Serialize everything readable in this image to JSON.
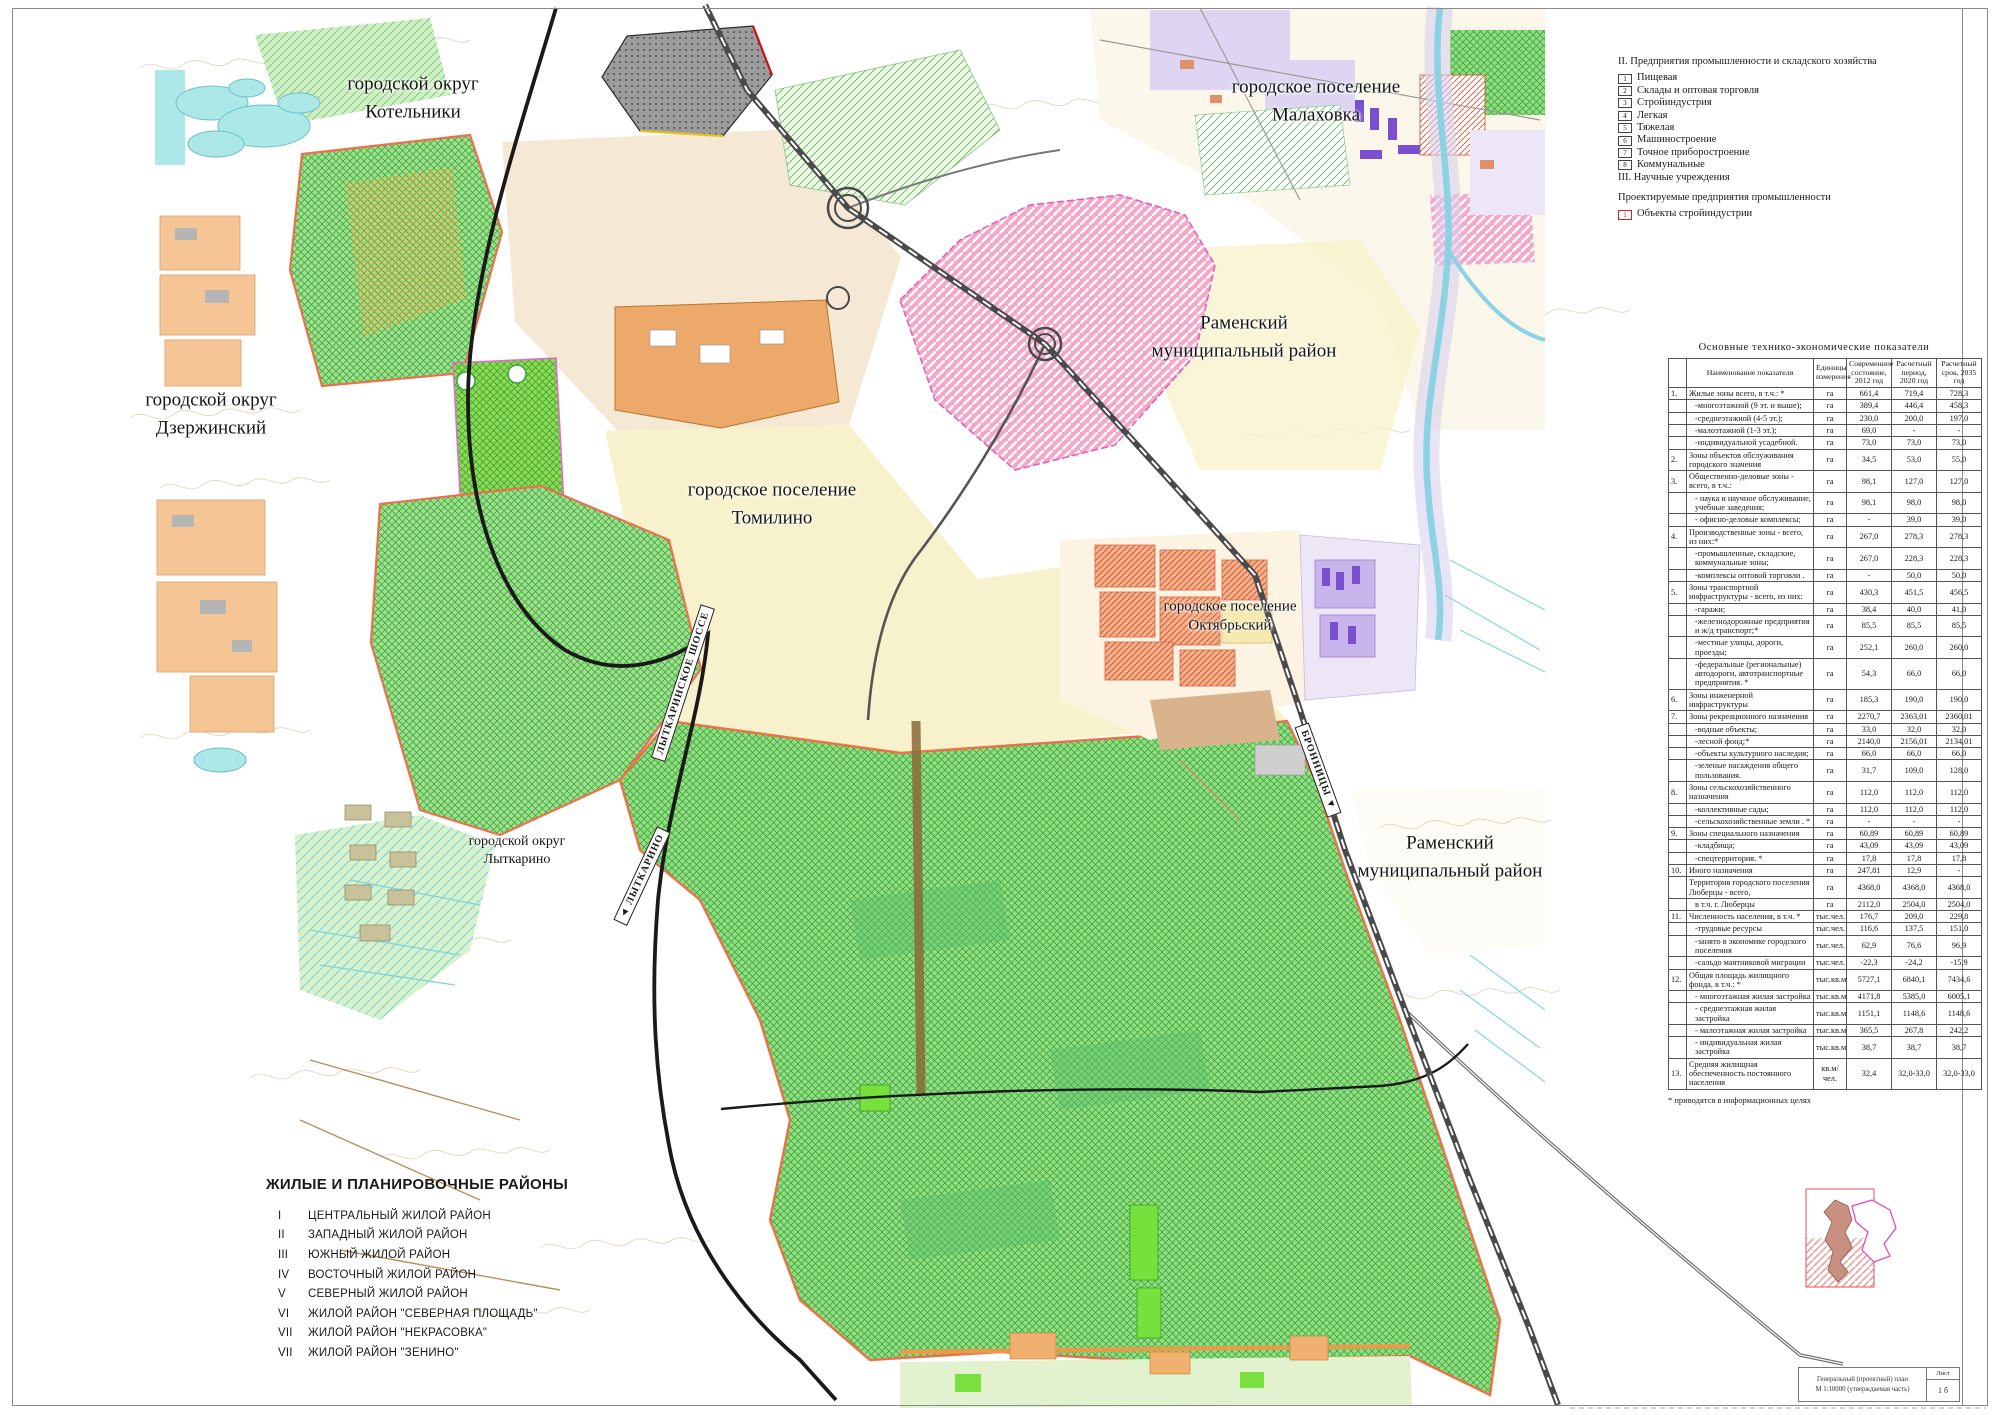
{
  "map": {
    "labels": [
      {
        "id": "kotelniki",
        "text": "городской округ\nКотельники"
      },
      {
        "id": "malahovka",
        "text": "городское поселение\nМалаховка"
      },
      {
        "id": "ramensky-ne",
        "text": "Раменский\nмуниципальный район"
      },
      {
        "id": "dzerzhinsky",
        "text": "городской округ\nДзержинский"
      },
      {
        "id": "tomilino",
        "text": "городское поселение\nТомилино"
      },
      {
        "id": "oktyabrsky",
        "text": "городское поселение\nОктябрьский"
      },
      {
        "id": "lytkarino",
        "text": "городской округ\nЛыткарино"
      },
      {
        "id": "ramensky-se",
        "text": "Раменский\nмуниципальный район"
      }
    ],
    "road_signs": [
      {
        "id": "lytkarinskoe-shosse",
        "text": "ЛЫТКАРИНСКОЕ ШОССЕ"
      },
      {
        "id": "lytkarino-direction",
        "text": "◄ ЛЫТКАРИНО"
      },
      {
        "id": "bronnitsy-direction",
        "text": "БРОННИЦЫ ▼"
      }
    ]
  },
  "industry_legend": {
    "section2_title": "II. Предприятия промышленности и складского хозяйства",
    "items": [
      {
        "num": "1",
        "label": "Пищевая"
      },
      {
        "num": "2",
        "label": "Склады и оптовая торговля"
      },
      {
        "num": "3",
        "label": "Стройиндустрия"
      },
      {
        "num": "4",
        "label": "Легкая"
      },
      {
        "num": "5",
        "label": "Тяжелая"
      },
      {
        "num": "6",
        "label": "Машиностроение"
      },
      {
        "num": "7",
        "label": "Точное приборостроение"
      },
      {
        "num": "8",
        "label": "Коммунальные"
      }
    ],
    "section3_title": "III.  Научные учреждения",
    "projected_title": "Проектируемые предприятия промышленности",
    "projected_items": [
      {
        "num": "1",
        "label": "Объекты стройиндустрии"
      }
    ]
  },
  "indicators_table": {
    "title": "Основные технико-экономические показатели",
    "columns": [
      "Наименование показателя",
      "Единицы измерения",
      "Современное состояние, 2012 год",
      "Расчетный период, 2020 год",
      "Расчетный срок, 2035 год"
    ],
    "rows": [
      {
        "n": "1.",
        "name": "Жилые зоны всего, в т.ч.: *",
        "unit": "га",
        "v": [
          "661,4",
          "719,4",
          "728,3"
        ]
      },
      {
        "n": "",
        "sub": true,
        "name": "-многоэтажной (9 эт. и выше);",
        "unit": "га",
        "v": [
          "389,4",
          "446,4",
          "458,3"
        ]
      },
      {
        "n": "",
        "sub": true,
        "name": "-среднеэтажной (4-5 эт.);",
        "unit": "га",
        "v": [
          "230,0",
          "200,0",
          "197,0"
        ]
      },
      {
        "n": "",
        "sub": true,
        "name": "-малоэтажной (1-3 эт.);",
        "unit": "га",
        "v": [
          "69,0",
          "-",
          "-"
        ]
      },
      {
        "n": "",
        "sub": true,
        "name": "-индивидуальной усадебной.",
        "unit": "га",
        "v": [
          "73,0",
          "73,0",
          "73,0"
        ]
      },
      {
        "n": "2.",
        "name": "Зоны объектов обслуживания городского значения",
        "unit": "га",
        "v": [
          "34,5",
          "53,0",
          "55,0"
        ]
      },
      {
        "n": "3.",
        "name": "Общественно-деловые зоны - всего, в т.ч.:",
        "unit": "га",
        "v": [
          "98,1",
          "127,0",
          "127,0"
        ]
      },
      {
        "n": "",
        "sub": true,
        "name": "- наука и научное обслуживание, учебные заведения;",
        "unit": "га",
        "v": [
          "98,1",
          "98,0",
          "98,0"
        ]
      },
      {
        "n": "",
        "sub": true,
        "name": "- офисно-деловые комплексы;",
        "unit": "га",
        "v": [
          "-",
          "39,0",
          "39,0"
        ]
      },
      {
        "n": "4.",
        "name": "Производственные зоны - всего, из них:*",
        "unit": "га",
        "v": [
          "267,0",
          "278,3",
          "278,3"
        ]
      },
      {
        "n": "",
        "sub": true,
        "name": "-промышленные, складские, коммунальные зоны;",
        "unit": "га",
        "v": [
          "267,0",
          "228,3",
          "228,3"
        ]
      },
      {
        "n": "",
        "sub": true,
        "name": "-комплексы оптовой торговли .",
        "unit": "га",
        "v": [
          "-",
          "50,0",
          "50,0"
        ]
      },
      {
        "n": "5.",
        "name": "Зоны транспортной инфраструктуры - всего, из них:",
        "unit": "га",
        "v": [
          "430,3",
          "451,5",
          "456,5"
        ]
      },
      {
        "n": "",
        "sub": true,
        "name": "-гаражи;",
        "unit": "га",
        "v": [
          "38,4",
          "40,0",
          "41,0"
        ]
      },
      {
        "n": "",
        "sub": true,
        "name": "-железнодорожные предприятия и ж/д транспорт;*",
        "unit": "га",
        "v": [
          "85,5",
          "85,5",
          "85,5"
        ]
      },
      {
        "n": "",
        "sub": true,
        "name": "-местные улицы, дороги, проезды;",
        "unit": "га",
        "v": [
          "252,1",
          "260,0",
          "260,0"
        ]
      },
      {
        "n": "",
        "sub": true,
        "name": "-федеральные (региональные) автодороги, автотранспортные предприятия. *",
        "unit": "га",
        "v": [
          "54,3",
          "66,0",
          "66,0"
        ]
      },
      {
        "n": "6.",
        "name": "Зоны инженерной инфраструктуры",
        "unit": "га",
        "v": [
          "185,3",
          "190,0",
          "190,0"
        ]
      },
      {
        "n": "7.",
        "name": "Зоны рекреационного назначения",
        "unit": "га",
        "v": [
          "2270,7",
          "2363,01",
          "2360,01"
        ]
      },
      {
        "n": "",
        "sub": true,
        "name": "-водные объекты;",
        "unit": "га",
        "v": [
          "33,0",
          "32,0",
          "32,0"
        ]
      },
      {
        "n": "",
        "sub": true,
        "name": "-лесной фонд;*",
        "unit": "га",
        "v": [
          "2140,0",
          "2156,01",
          "2134,01"
        ]
      },
      {
        "n": "",
        "sub": true,
        "name": "-объекты культурного наследия;",
        "unit": "га",
        "v": [
          "66,0",
          "66,0",
          "66,0"
        ]
      },
      {
        "n": "",
        "sub": true,
        "name": "-зеленые насаждения общего пользования.",
        "unit": "га",
        "v": [
          "31,7",
          "109,0",
          "128,0"
        ]
      },
      {
        "n": "8.",
        "name": "Зоны сельскохозяйственного назначения",
        "unit": "га",
        "v": [
          "112,0",
          "112,0",
          "112,0"
        ]
      },
      {
        "n": "",
        "sub": true,
        "name": "-коллективные сады;",
        "unit": "га",
        "v": [
          "112,0",
          "112,0",
          "112,0"
        ]
      },
      {
        "n": "",
        "sub": true,
        "name": "-сельскохозяйственные земли . *",
        "unit": "га",
        "v": [
          "-",
          "-",
          "-"
        ]
      },
      {
        "n": "9.",
        "name": "Зоны специального назначения",
        "unit": "га",
        "v": [
          "60,89",
          "60,89",
          "60,89"
        ]
      },
      {
        "n": "",
        "sub": true,
        "name": "-кладбища;",
        "unit": "га",
        "v": [
          "43,09",
          "43,09",
          "43,09"
        ]
      },
      {
        "n": "",
        "sub": true,
        "name": "-спецтерритория. *",
        "unit": "га",
        "v": [
          "17,8",
          "17,8",
          "17,8"
        ]
      },
      {
        "n": "10.",
        "name": "Иного назначения",
        "unit": "га",
        "v": [
          "247,81",
          "12,9",
          "-"
        ]
      },
      {
        "n": "",
        "name": "Территория городского поселения Люберцы - всего,",
        "unit": "га",
        "v": [
          "4368,0",
          "4368,0",
          "4368,0"
        ]
      },
      {
        "n": "",
        "sub": true,
        "name": "в т.ч. г. Люберцы",
        "unit": "га",
        "v": [
          "2112,0",
          "2504,0",
          "2504,0"
        ]
      },
      {
        "n": "11.",
        "name": "Численность населения, в т.ч. *",
        "unit": "тыс.чел.",
        "v": [
          "176,7",
          "209,0",
          "229,8"
        ]
      },
      {
        "n": "",
        "sub": true,
        "name": "-трудовые ресурсы",
        "unit": "тыс.чел.",
        "v": [
          "116,6",
          "137,5",
          "151,0"
        ]
      },
      {
        "n": "",
        "sub": true,
        "name": "-занято в экономике городского поселения",
        "unit": "тыс.чел.",
        "v": [
          "62,9",
          "76,6",
          "96,9"
        ]
      },
      {
        "n": "",
        "sub": true,
        "name": "-сальдо маятниковой миграции",
        "unit": "тыс.чел.",
        "v": [
          "-22,3",
          "-24,2",
          "-15,9"
        ]
      },
      {
        "n": "12.",
        "name": "Общая площадь жилищного фонда, в т.ч.: *",
        "unit": "тыс.кв.м",
        "v": [
          "5727,1",
          "6840,1",
          "7434,6"
        ]
      },
      {
        "n": "",
        "sub": true,
        "name": "- многоэтажная жилая застройка",
        "unit": "тыс.кв.м",
        "v": [
          "4171,8",
          "5385,0",
          "6005,1"
        ]
      },
      {
        "n": "",
        "sub": true,
        "name": "- среднеэтажная жилая застройка",
        "unit": "тыс.кв.м",
        "v": [
          "1151,1",
          "1148,6",
          "1148,6"
        ]
      },
      {
        "n": "",
        "sub": true,
        "name": "- малоэтажная жилая застройка",
        "unit": "тыс.кв.м",
        "v": [
          "365,5",
          "267,8",
          "242,2"
        ]
      },
      {
        "n": "",
        "sub": true,
        "name": "- индивидуальная жилая застройка",
        "unit": "тыс.кв.м",
        "v": [
          "38,7",
          "38,7",
          "38,7"
        ]
      },
      {
        "n": "13.",
        "name": "Средняя жилищная обеспеченность постоянного населения",
        "unit": "кв.м/чел.",
        "v": [
          "32,4",
          "32,0-33,0",
          "32,0-33,0"
        ]
      }
    ],
    "footnote": "* приводятся в информационных целях"
  },
  "districts_legend": {
    "title": "ЖИЛЫЕ И ПЛАНИРОВОЧНЫЕ РАЙОНЫ",
    "items": [
      {
        "num": "I",
        "label": "ЦЕНТРАЛЬНЫЙ ЖИЛОЙ РАЙОН"
      },
      {
        "num": "II",
        "label": "ЗАПАДНЫЙ ЖИЛОЙ  РАЙОН"
      },
      {
        "num": "III",
        "label": "ЮЖНЫЙ  ЖИЛОЙ  РАЙОН"
      },
      {
        "num": "IV",
        "label": "ВОСТОЧНЫЙ ЖИЛОЙ РАЙОН"
      },
      {
        "num": "V",
        "label": "СЕВЕРНЫЙ  ЖИЛОЙ  РАЙОН"
      },
      {
        "num": "VI",
        "label": "ЖИЛОЙ  РАЙОН \"СЕВЕРНАЯ ПЛОЩАДЬ\""
      },
      {
        "num": "VII",
        "label": "ЖИЛОЙ РАЙОН \"НЕКРАСОВКА\""
      },
      {
        "num": "VII",
        "label": "ЖИЛОЙ РАЙОН \"ЗЕНИНО\""
      }
    ]
  },
  "title_block": {
    "line1": "Генеральный (проектный) план",
    "line2": "М 1:10000 (утверждаемая часть)",
    "sheet_label": "Лист",
    "sheet_number": "1 б"
  },
  "colors": {
    "forest_green": "#93dd84",
    "marsh_green": "#d9f2c9",
    "pink_zone": "#f6a6c6",
    "boundary_orange": "#f07818",
    "boundary_magenta": "#e060c0",
    "water": "#8ad2e4",
    "urban_peach": "#f6c596",
    "industrial_orange": "#eda96a",
    "projected_red": "#cc2222",
    "purple_zone": "#c9b4ec",
    "landfill_gray": "#9c9c9c"
  }
}
